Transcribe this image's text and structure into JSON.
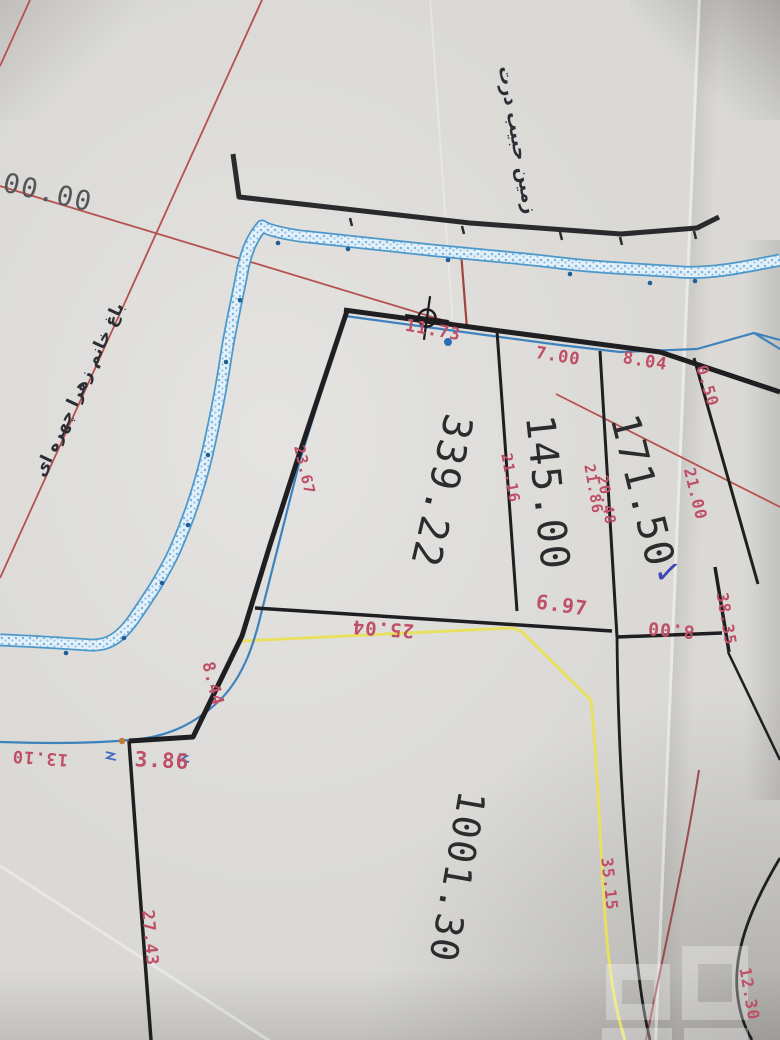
{
  "scene_title": "cadastral survey map photo",
  "colors": {
    "dim_red": "#bf4f66",
    "area_black": "#2c2c2e",
    "pencil": "#54555a",
    "ink_blue": "#3f46b5",
    "persian": "#2b2e35",
    "stream_blue": "#4d97c9",
    "boundary_black": "#1f1f22",
    "grid_red": "#b5524f",
    "access_yellow": "#e8e060",
    "maroon": "#9c4a50",
    "orange_dot": "#bf7a36"
  },
  "watermark": {
    "name": "photo-watermark",
    "style": "translucent blocky logo"
  },
  "labels": [
    {
      "name": "edge-dimension-00-00",
      "text": "00.00",
      "x": 48,
      "y": 193,
      "rot": 13,
      "fs": 27,
      "color": "pencil",
      "cls": "big"
    },
    {
      "name": "plot-name-top",
      "text": "زمین حبیب درت",
      "x": 517,
      "y": 140,
      "rot": 80,
      "fs": 19,
      "color": "persian",
      "cls": "fa"
    },
    {
      "name": "plot-name-left",
      "text": "باغ خانم زهرا چهره ای",
      "x": 80,
      "y": 390,
      "rot": -65,
      "fs": 17,
      "color": "persian",
      "cls": "fa"
    },
    {
      "name": "dim-11-73",
      "text": "11.73",
      "x": 433,
      "y": 331,
      "rot": 10,
      "fs": 17,
      "color": "dim_red"
    },
    {
      "name": "dim-7-00",
      "text": "7.00",
      "x": 558,
      "y": 357,
      "rot": 9,
      "fs": 17,
      "color": "dim_red"
    },
    {
      "name": "dim-8-04",
      "text": "8.04",
      "x": 645,
      "y": 362,
      "rot": 9,
      "fs": 17,
      "color": "dim_red"
    },
    {
      "name": "dim-0-50",
      "text": "0.50",
      "x": 707,
      "y": 386,
      "rot": 73,
      "fs": 16,
      "color": "dim_red"
    },
    {
      "name": "dim-21-00",
      "text": "21.00",
      "x": 695,
      "y": 494,
      "rot": 76,
      "fs": 16,
      "color": "dim_red"
    },
    {
      "name": "dim-21-86",
      "text": "21.86",
      "x": 593,
      "y": 489,
      "rot": 80,
      "fs": 15,
      "color": "dim_red"
    },
    {
      "name": "dim-20-48",
      "text": "20.48",
      "x": 606,
      "y": 500,
      "rot": 80,
      "fs": 15,
      "color": "dim_red"
    },
    {
      "name": "dim-21-16",
      "text": "21.16",
      "x": 510,
      "y": 478,
      "rot": 80,
      "fs": 15,
      "color": "dim_red"
    },
    {
      "name": "dim-23-67",
      "text": "23.67",
      "x": 304,
      "y": 470,
      "rot": 77,
      "fs": 15,
      "color": "dim_red"
    },
    {
      "name": "area-171-50",
      "text": "171.50",
      "x": 642,
      "y": 491,
      "rot": 76,
      "fs": 40,
      "color": "area_black",
      "cls": "big"
    },
    {
      "name": "area-145-00",
      "text": "145.00",
      "x": 547,
      "y": 493,
      "rot": 84,
      "fs": 40,
      "color": "area_black",
      "cls": "big"
    },
    {
      "name": "area-339-22",
      "text": "339.22",
      "x": 441,
      "y": 491,
      "rot": 103,
      "fs": 40,
      "color": "area_black",
      "cls": "big"
    },
    {
      "name": "area-1001-30",
      "text": "1001.30",
      "x": 457,
      "y": 877,
      "rot": 100,
      "fs": 38,
      "color": "area_black",
      "cls": "big"
    },
    {
      "name": "dim-6-97",
      "text": "6.97",
      "x": 562,
      "y": 605,
      "rot": 8,
      "fs": 20,
      "color": "dim_red"
    },
    {
      "name": "dim-8-00",
      "text": "8.00",
      "x": 671,
      "y": 629,
      "rot": 185,
      "fs": 18,
      "color": "dim_red"
    },
    {
      "name": "dim-25-04",
      "text": "25.04",
      "x": 383,
      "y": 628,
      "rot": 184,
      "fs": 19,
      "color": "dim_red"
    },
    {
      "name": "dim-38-35",
      "text": "38.35",
      "x": 726,
      "y": 619,
      "rot": 80,
      "fs": 16,
      "color": "dim_red"
    },
    {
      "name": "dim-8-44",
      "text": "8.44",
      "x": 212,
      "y": 684,
      "rot": 76,
      "fs": 17,
      "color": "dim_red"
    },
    {
      "name": "dim-3-86",
      "text": "3.86",
      "x": 162,
      "y": 761,
      "rot": 3,
      "fs": 21,
      "color": "dim_red"
    },
    {
      "name": "dim-13-10",
      "text": "13.10",
      "x": 40,
      "y": 757,
      "rot": 184,
      "fs": 17,
      "color": "dim_red"
    },
    {
      "name": "dim-27-43",
      "text": "27.43",
      "x": 149,
      "y": 938,
      "rot": 85,
      "fs": 17,
      "color": "dim_red"
    },
    {
      "name": "dim-35-15",
      "text": "35.15",
      "x": 609,
      "y": 884,
      "rot": 84,
      "fs": 16,
      "color": "dim_red"
    },
    {
      "name": "dim-12-30",
      "text": "12.30",
      "x": 749,
      "y": 994,
      "rot": 80,
      "fs": 16,
      "color": "dim_red"
    },
    {
      "name": "ink-checkmark",
      "text": "✓",
      "x": 668,
      "y": 571,
      "rot": 8,
      "fs": 38,
      "color": "ink_blue"
    }
  ]
}
